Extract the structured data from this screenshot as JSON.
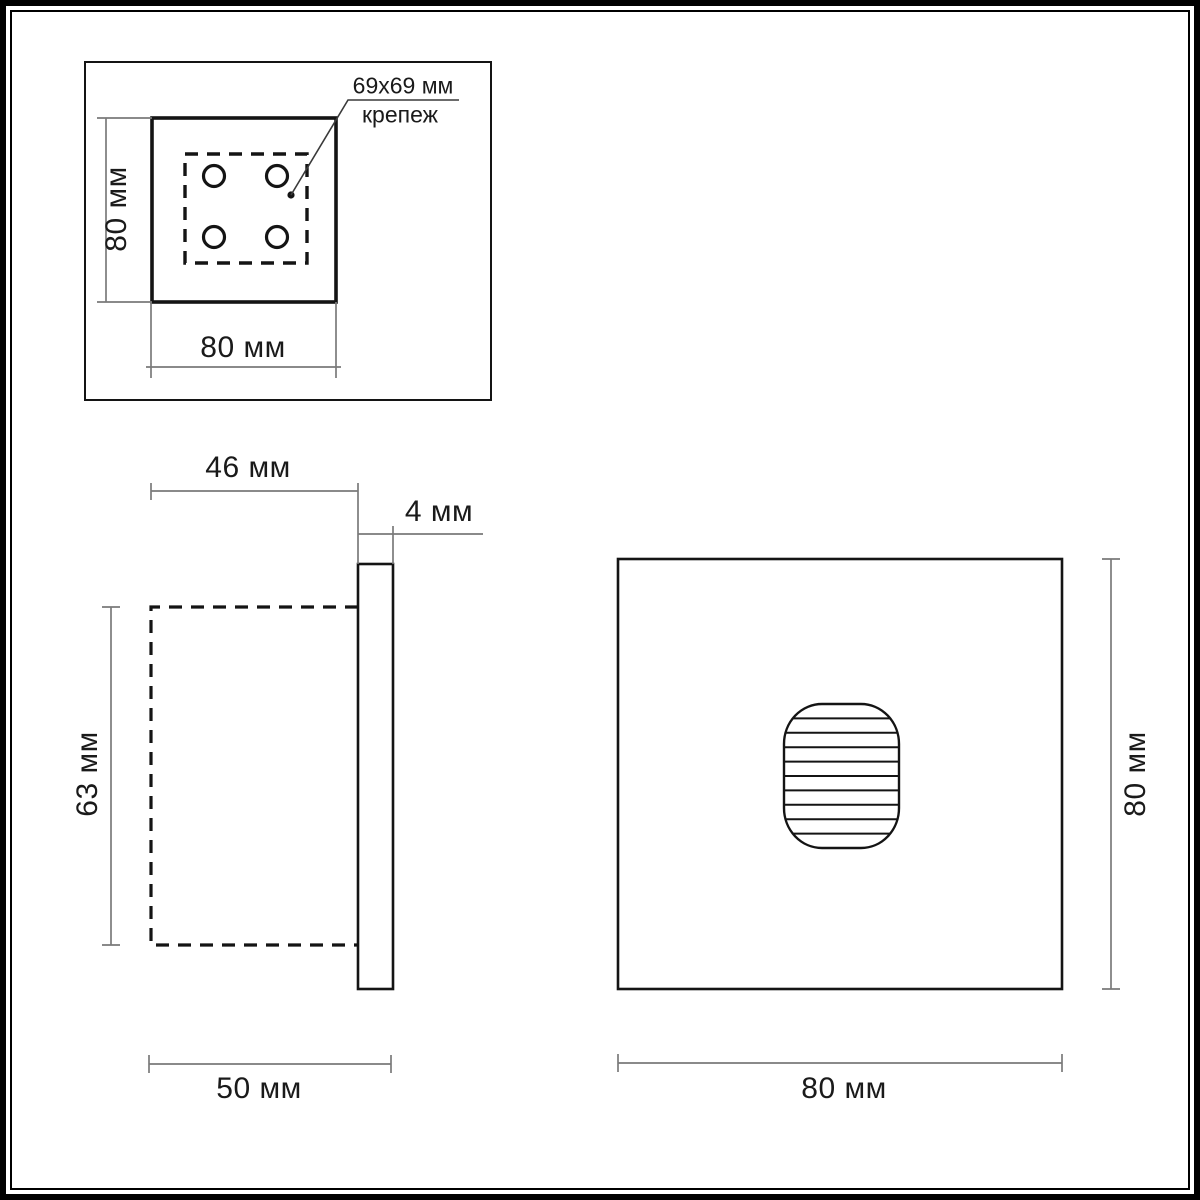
{
  "drawing": {
    "title": "wall-light-dimension-drawing",
    "top_view": {
      "height_label": "80 мм",
      "width_label": "80 мм",
      "mount_line1": "69x69 мм",
      "mount_line2": "крепеж"
    },
    "side_view": {
      "recess_depth_label": "46 мм",
      "plate_thickness_label": "4 мм",
      "recess_height_label": "63 мм",
      "total_depth_label": "50 мм"
    },
    "front_view": {
      "width_label": "80 мм",
      "height_label": "80 мм"
    },
    "colors": {
      "object_line": "#141414",
      "dim_line": "#7a7a7a",
      "background": "#ffffff"
    }
  }
}
